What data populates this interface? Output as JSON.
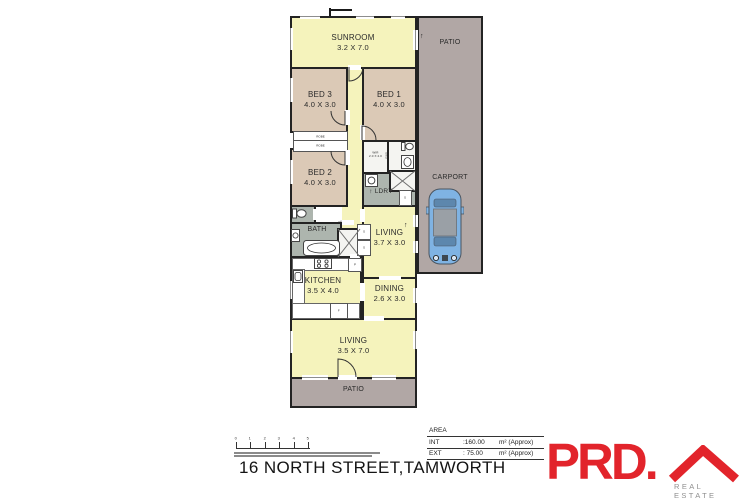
{
  "colors": {
    "room_yellow": "#F5F3BC",
    "room_tan": "#DBC9B6",
    "room_wet_gray": "#ADB5AE",
    "patio_gray": "#B1A7A5",
    "wall": "#232323",
    "brand_red": "#E2242B",
    "car_blue": "#7FB3E3"
  },
  "plan": {
    "rooms": {
      "sunroom": {
        "name": "SUNROOM",
        "dims": "3.2 X 7.0"
      },
      "patio_top": {
        "name": "PATIO"
      },
      "carport": {
        "name": "CARPORT"
      },
      "bed3": {
        "name": "BED 3",
        "dims": "4.0 X 3.0"
      },
      "bed1": {
        "name": "BED 1",
        "dims": "4.0 X 3.0"
      },
      "bed2": {
        "name": "BED 2",
        "dims": "4.0 X 3.0"
      },
      "robe": {
        "name": "ROBE"
      },
      "wir": {
        "name": "WIR",
        "dims": "2.0 X 2.0"
      },
      "ens": {
        "name": "ENS"
      },
      "ldry": {
        "name": "LDRY"
      },
      "bath": {
        "name": "BATH"
      },
      "living_small": {
        "name": "LIVING",
        "dims": "3.7 X 3.0"
      },
      "kitchen": {
        "name": "KITCHEN",
        "dims": "3.5 X 4.0"
      },
      "dining": {
        "name": "DINING",
        "dims": "2.6 X 3.0"
      },
      "living_large": {
        "name": "LIVING",
        "dims": "3.5 X 7.0"
      },
      "patio_bottom": {
        "name": "PATIO"
      }
    },
    "markers": {
      "storage": "S",
      "fridge": "F",
      "pantry": "P",
      "arrow_up": "↑",
      "arrow_right": "→"
    }
  },
  "scale_bar": {
    "ticks": [
      "0",
      "1",
      "2",
      "3",
      "4",
      "5"
    ]
  },
  "area_table": {
    "title": "AREA",
    "rows": [
      {
        "label": "INT",
        "value": ":160.00",
        "unit": "m² (Approx)"
      },
      {
        "label": "EXT",
        "value": ": 75.00",
        "unit": "m² (Approx)"
      }
    ]
  },
  "address": "16 NORTH STREET,TAMWORTH",
  "brand": {
    "wordmark": "PRD.",
    "tagline": "REAL ESTATE"
  }
}
